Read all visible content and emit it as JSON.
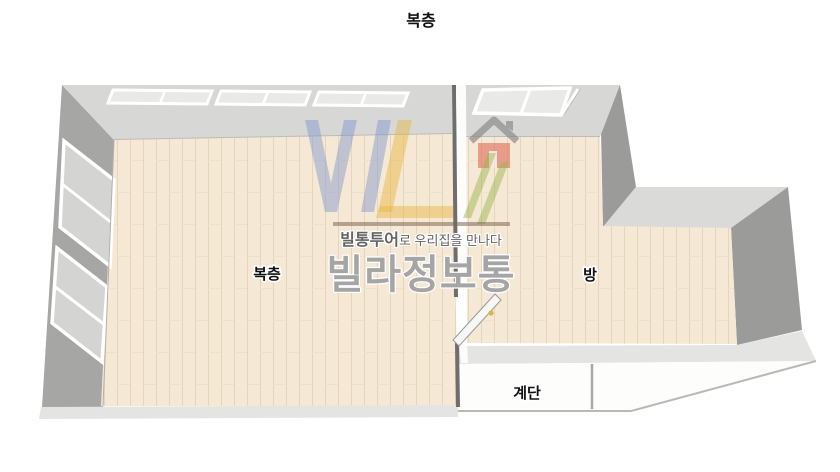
{
  "page": {
    "title": "복층",
    "background": "#ffffff"
  },
  "floorplan": {
    "rooms": [
      {
        "id": "loft",
        "label": "복층"
      },
      {
        "id": "room",
        "label": "방"
      },
      {
        "id": "stairs",
        "label": "계단"
      }
    ],
    "colors": {
      "floor": "#f5e8d4",
      "floor_plank_line": "#e6d5bc",
      "wall_top": "#d7d7d5",
      "wall_side": "#a6a6a4",
      "wall_dark": "#9b9b99",
      "wall_mid": "#dadad8",
      "wall_bottom": "#e4e4e2",
      "stairs_floor": "#fdfdfc",
      "stairs_line": "#a9a9a7",
      "divider": "#6e6e6c",
      "divider_highlight": "#fcfcfb",
      "window_pane": "#e9e9e8",
      "window_pane_side": "#d4d4d3",
      "window_frame": "#ffffff",
      "door_leaf": "#f7f7f6",
      "door_handle": "#d9b83f",
      "label_text": "#111111"
    }
  },
  "watermark": {
    "tagline_brand": "빌통투어",
    "tagline_rest": "로 우리집을 만나다",
    "brand": "빌라정보통",
    "colors": {
      "logo_blue": "#6e8ccd",
      "logo_yellow": "#e8b43c",
      "logo_green": "#96b246",
      "house_body": "#e0705c",
      "house_roof": "#828280",
      "rule_brown": "#7d6955",
      "tagline_text": "#4f4f4f",
      "brand_text": "#919191"
    }
  }
}
